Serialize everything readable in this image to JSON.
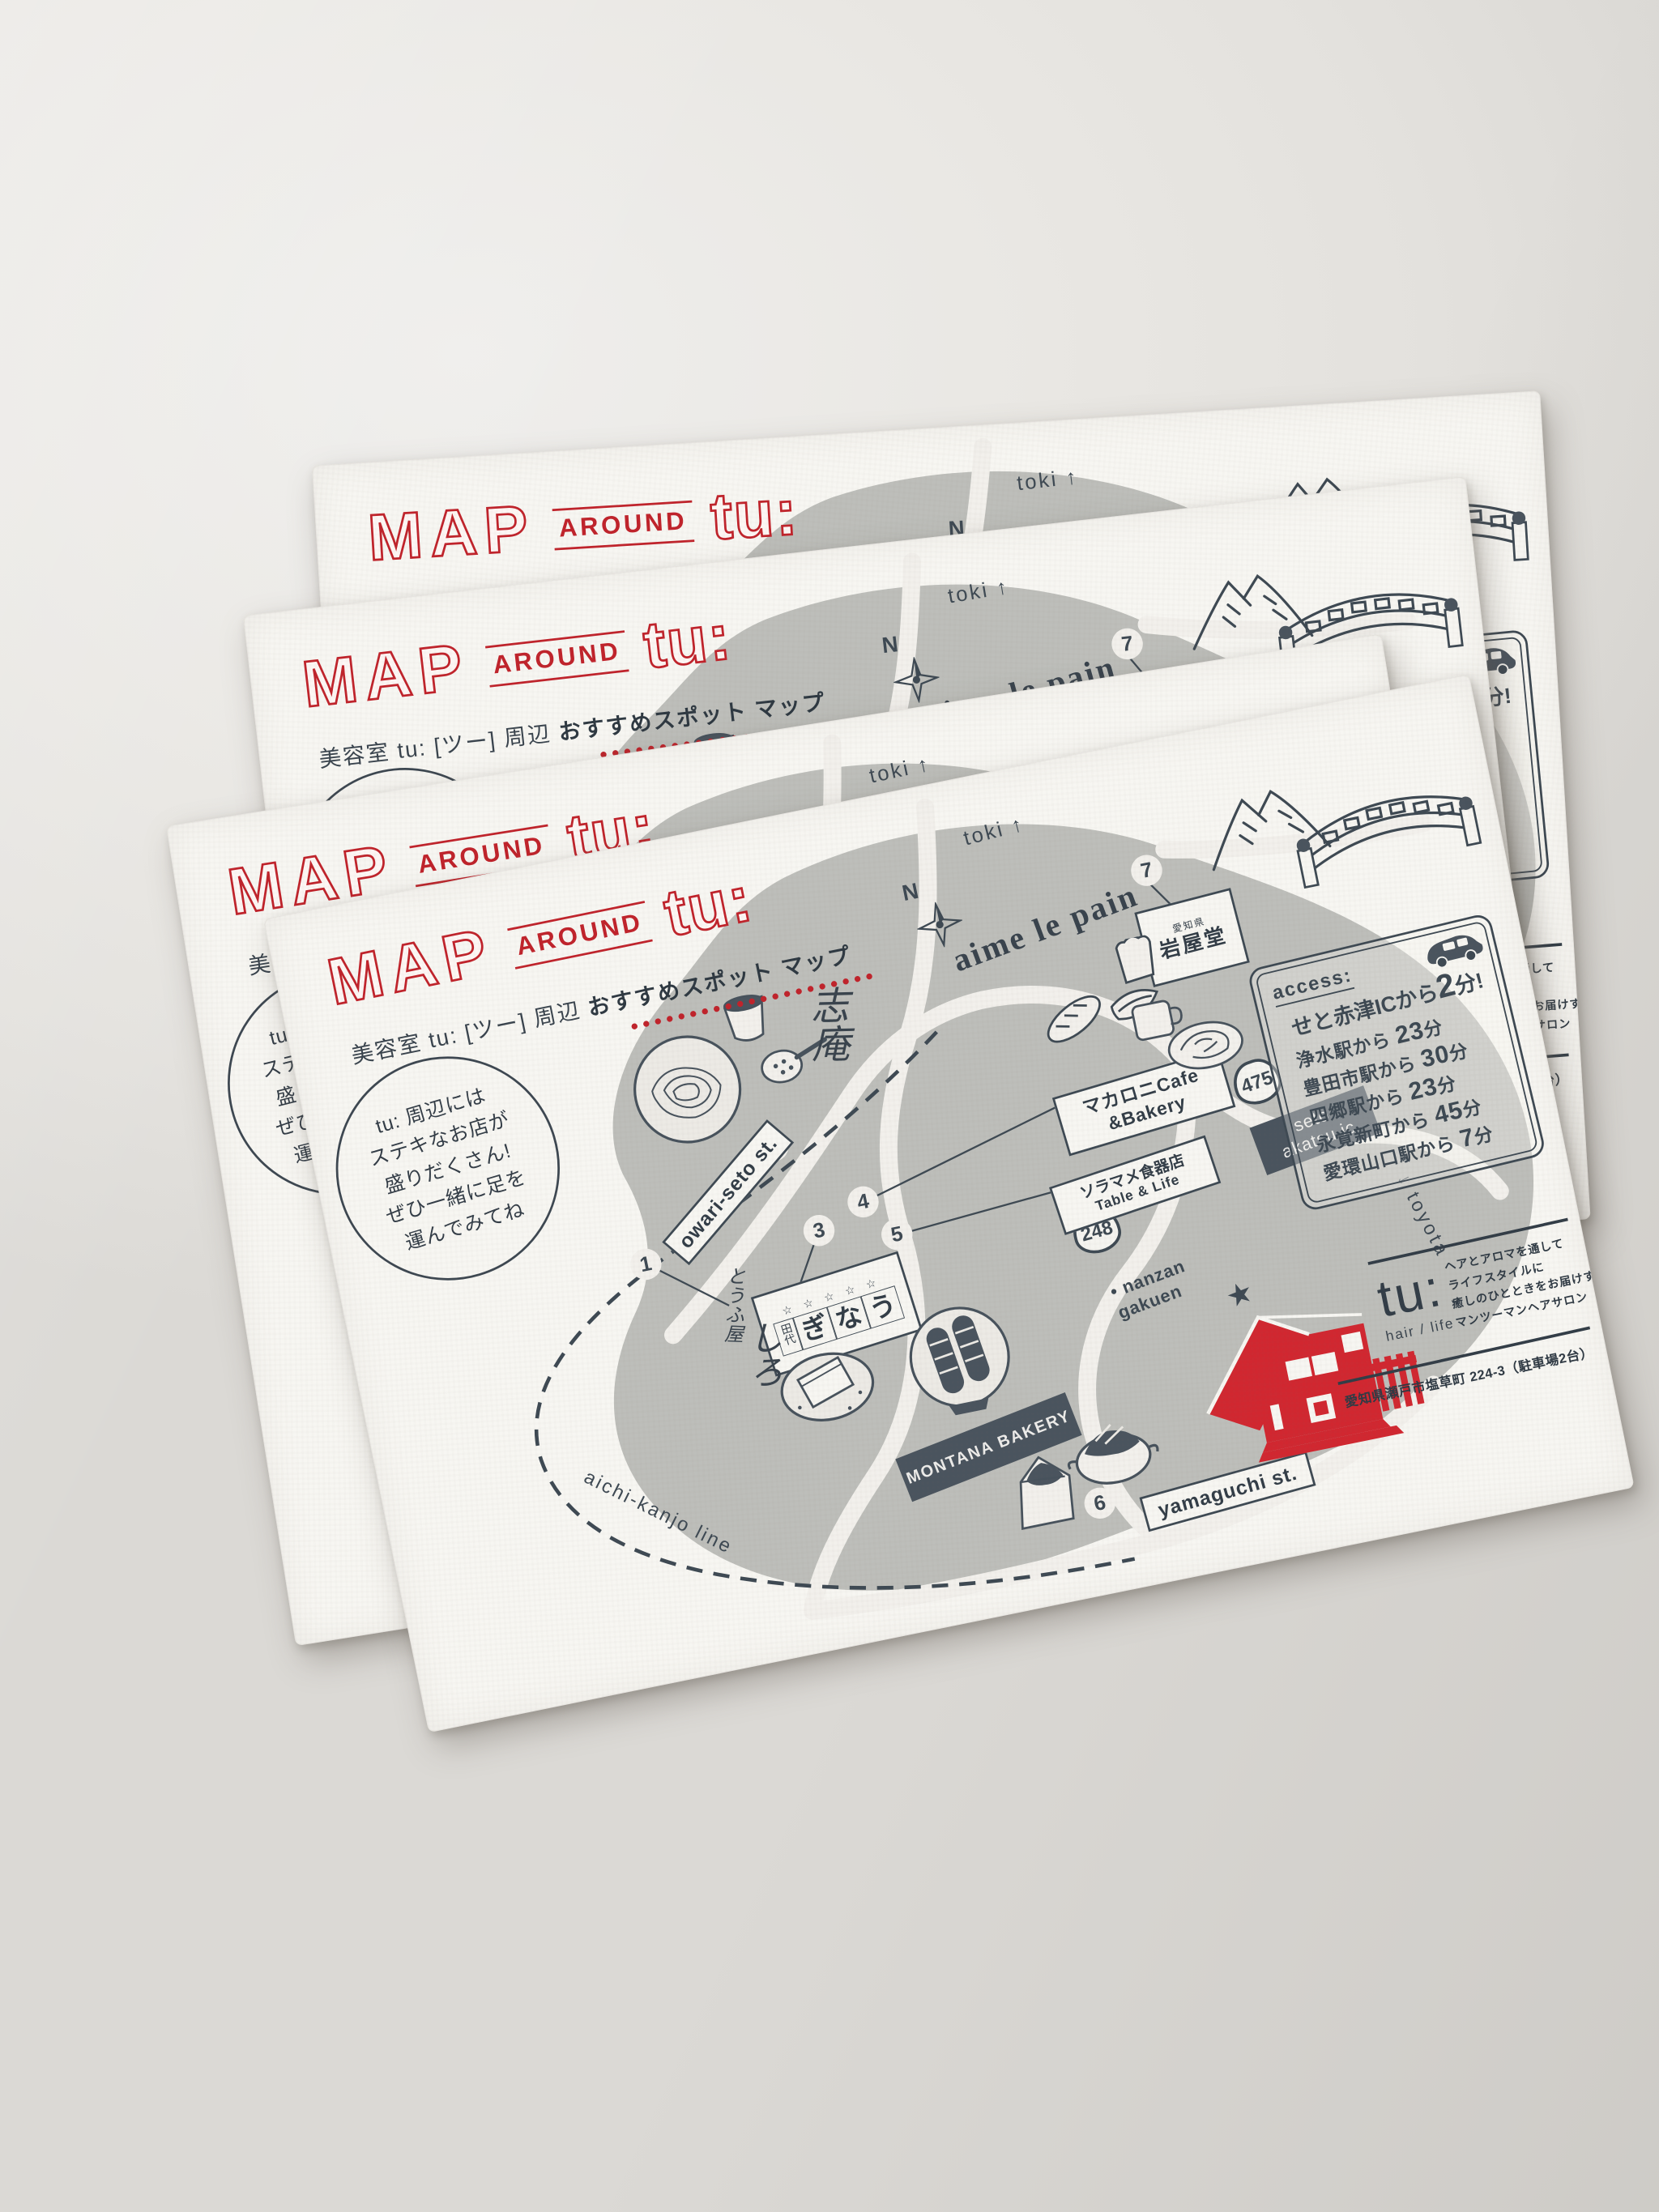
{
  "photo": {
    "scene": "stack of four letterpress postcards fanned on a gray surface",
    "colors": {
      "accent_red": "#c0232b",
      "ink": "#3e4953",
      "map_gray": "#bdbeba",
      "paper": "#f7f6f2",
      "background": "#e8e6e2"
    }
  },
  "card": {
    "title": {
      "map": "MAP",
      "around": "AROUND",
      "tu": "tu:"
    },
    "subtitle": {
      "normal": "美容室 tu: [ツー] 周辺",
      "bold": "おすすめスポット マップ"
    },
    "bubble": [
      "tu: 周辺には",
      "ステキなお店が",
      "盛りだくさん!",
      "ぜひ一緒に足を",
      "運んでみてね"
    ],
    "compass": "N",
    "labels": {
      "toki": "toki ↑",
      "owari": "owari-seto st.",
      "yamaguchi": "yamaguchi st.",
      "kanjo": "aichi-kanjo line",
      "toyota": "↓ toyota",
      "nanzan_dot": "•",
      "nanzan": "nanzan gakuen",
      "r475": "475",
      "r248": "248",
      "seto_ic_1": "seto",
      "seto_ic_2": "akatsu ic"
    },
    "spots": {
      "n1": "1",
      "tofu_1": "とうふ屋",
      "tofu_2": "しろ",
      "n2": "2",
      "soba": "志庵",
      "n3": "3",
      "unagi": {
        "p1": "田代",
        "p2": "ぎ",
        "p3": "な",
        "p4": "う",
        "stars": "☆ ☆ ☆ ☆ ☆"
      },
      "n4": "4",
      "cafe_1": "マカロニCafe",
      "cafe_2": "&Bakery",
      "n5": "5",
      "soramame_1": "ソラマメ食器店",
      "soramame_2": "Table & Life",
      "n6": "6",
      "montana": "MONTANA BAKERY",
      "n7": "7",
      "iwayado_pref": "愛知県",
      "iwayado": "岩屋堂",
      "aime": "aime le pain"
    },
    "access": {
      "heading": "access:",
      "highlight": {
        "pre": "せと赤津ICから",
        "num": "2",
        "suf": "分!"
      },
      "rows": [
        {
          "pre": "浄水駅から",
          "num": "23",
          "suf": "分"
        },
        {
          "pre": "豊田市駅から",
          "num": "30",
          "suf": "分"
        },
        {
          "pre": "四郷駅から",
          "num": "23",
          "suf": "分"
        },
        {
          "pre": "永覚新町から",
          "num": "45",
          "suf": "分"
        },
        {
          "pre": "愛環山口駅から",
          "num": "7",
          "suf": "分"
        }
      ]
    },
    "salon": {
      "logo": "tu:",
      "logo_sub": "hair / life",
      "tagline": [
        "ヘアとアロマを通して",
        "ライフスタイルに",
        "癒しのひとときをお届けする",
        "マンツーマンヘアサロン"
      ],
      "address": "愛知県瀬戸市塩草町 224-3（駐車場2台）"
    }
  }
}
